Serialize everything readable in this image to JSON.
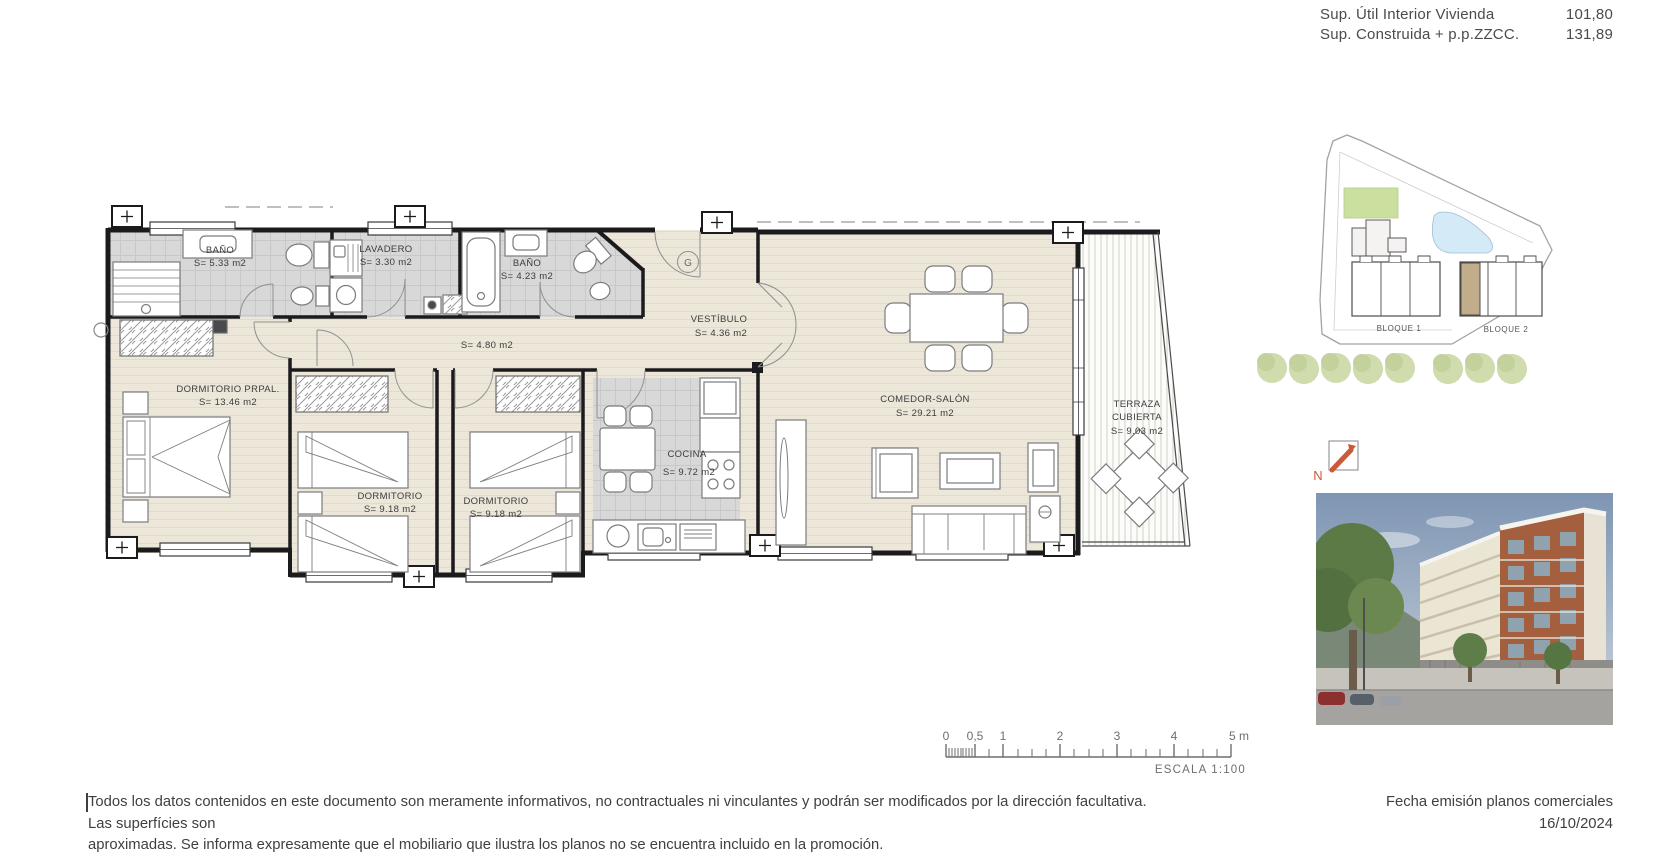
{
  "header": {
    "rows": [
      {
        "label": "Sup. Útil Interior Vivienda",
        "value": "101,80"
      },
      {
        "label": "Sup. Construida + p.p.ZZCC.",
        "value": "131,89"
      }
    ]
  },
  "floorplan": {
    "rooms": [
      {
        "id": "bano-1",
        "name": "BAÑO",
        "area": "S= 5.33 m2"
      },
      {
        "id": "lavadero",
        "name": "LAVADERO",
        "area": "S= 3.30 m2"
      },
      {
        "id": "bano-2",
        "name": "BAÑO",
        "area": "S= 4.23 m2"
      },
      {
        "id": "vestibulo",
        "name": "VESTÍBULO",
        "area": "S= 4.36 m2"
      },
      {
        "id": "pasillo",
        "name": "",
        "area": "S= 4.80 m2"
      },
      {
        "id": "dormitorio-principal",
        "name": "DORMITORIO PRPAL.",
        "area": "S= 13.46 m2"
      },
      {
        "id": "dormitorio-2",
        "name": "DORMITORIO",
        "area": "S= 9.18 m2"
      },
      {
        "id": "dormitorio-3",
        "name": "DORMITORIO",
        "area": "S= 9.18 m2"
      },
      {
        "id": "cocina",
        "name": "COCINA",
        "area": "S= 9.72 m2"
      },
      {
        "id": "comedor-salon",
        "name": "COMEDOR-SALÓN",
        "area": "S= 29.21 m2"
      },
      {
        "id": "terraza-cubierta",
        "name": "TERRAZA",
        "name2": "CUBIERTA",
        "area": "S= 9.03 m2"
      }
    ],
    "entry_symbol": "G"
  },
  "siteplan": {
    "blocks": [
      "BLOQUE 1",
      "BLOQUE 2"
    ]
  },
  "north_label": "N",
  "scalebar": {
    "ticks": [
      "0",
      "0,5",
      "1",
      "2",
      "3",
      "4",
      "5 m"
    ],
    "escala": "ESCALA  1:100"
  },
  "footer": {
    "disclaimer_line1": "Todos los datos contenidos en este documento son meramente informativos, no contractuales ni vinculantes y podrán ser modificados por la dirección facultativa. Las superfícies son",
    "disclaimer_line2": "aproximadas. Se informa expresamente que el mobiliario que ilustra los planos no se encuentra incluido en la promoción.",
    "fecha_label": "Fecha emisión planos comerciales",
    "fecha_value": "16/10/2024"
  },
  "colors": {
    "wall": "#1b1b1d",
    "floor_beige": "#ece7d9",
    "tile_gray": "#d8d8d8",
    "terrace_stripe": "#ccd3c3",
    "north_orange": "#cb5a38",
    "site_green": "#cbdf9f",
    "pool_blue": "#d4eaf7",
    "unit_tan": "#c2ad8a",
    "text": "#3f3f41"
  }
}
